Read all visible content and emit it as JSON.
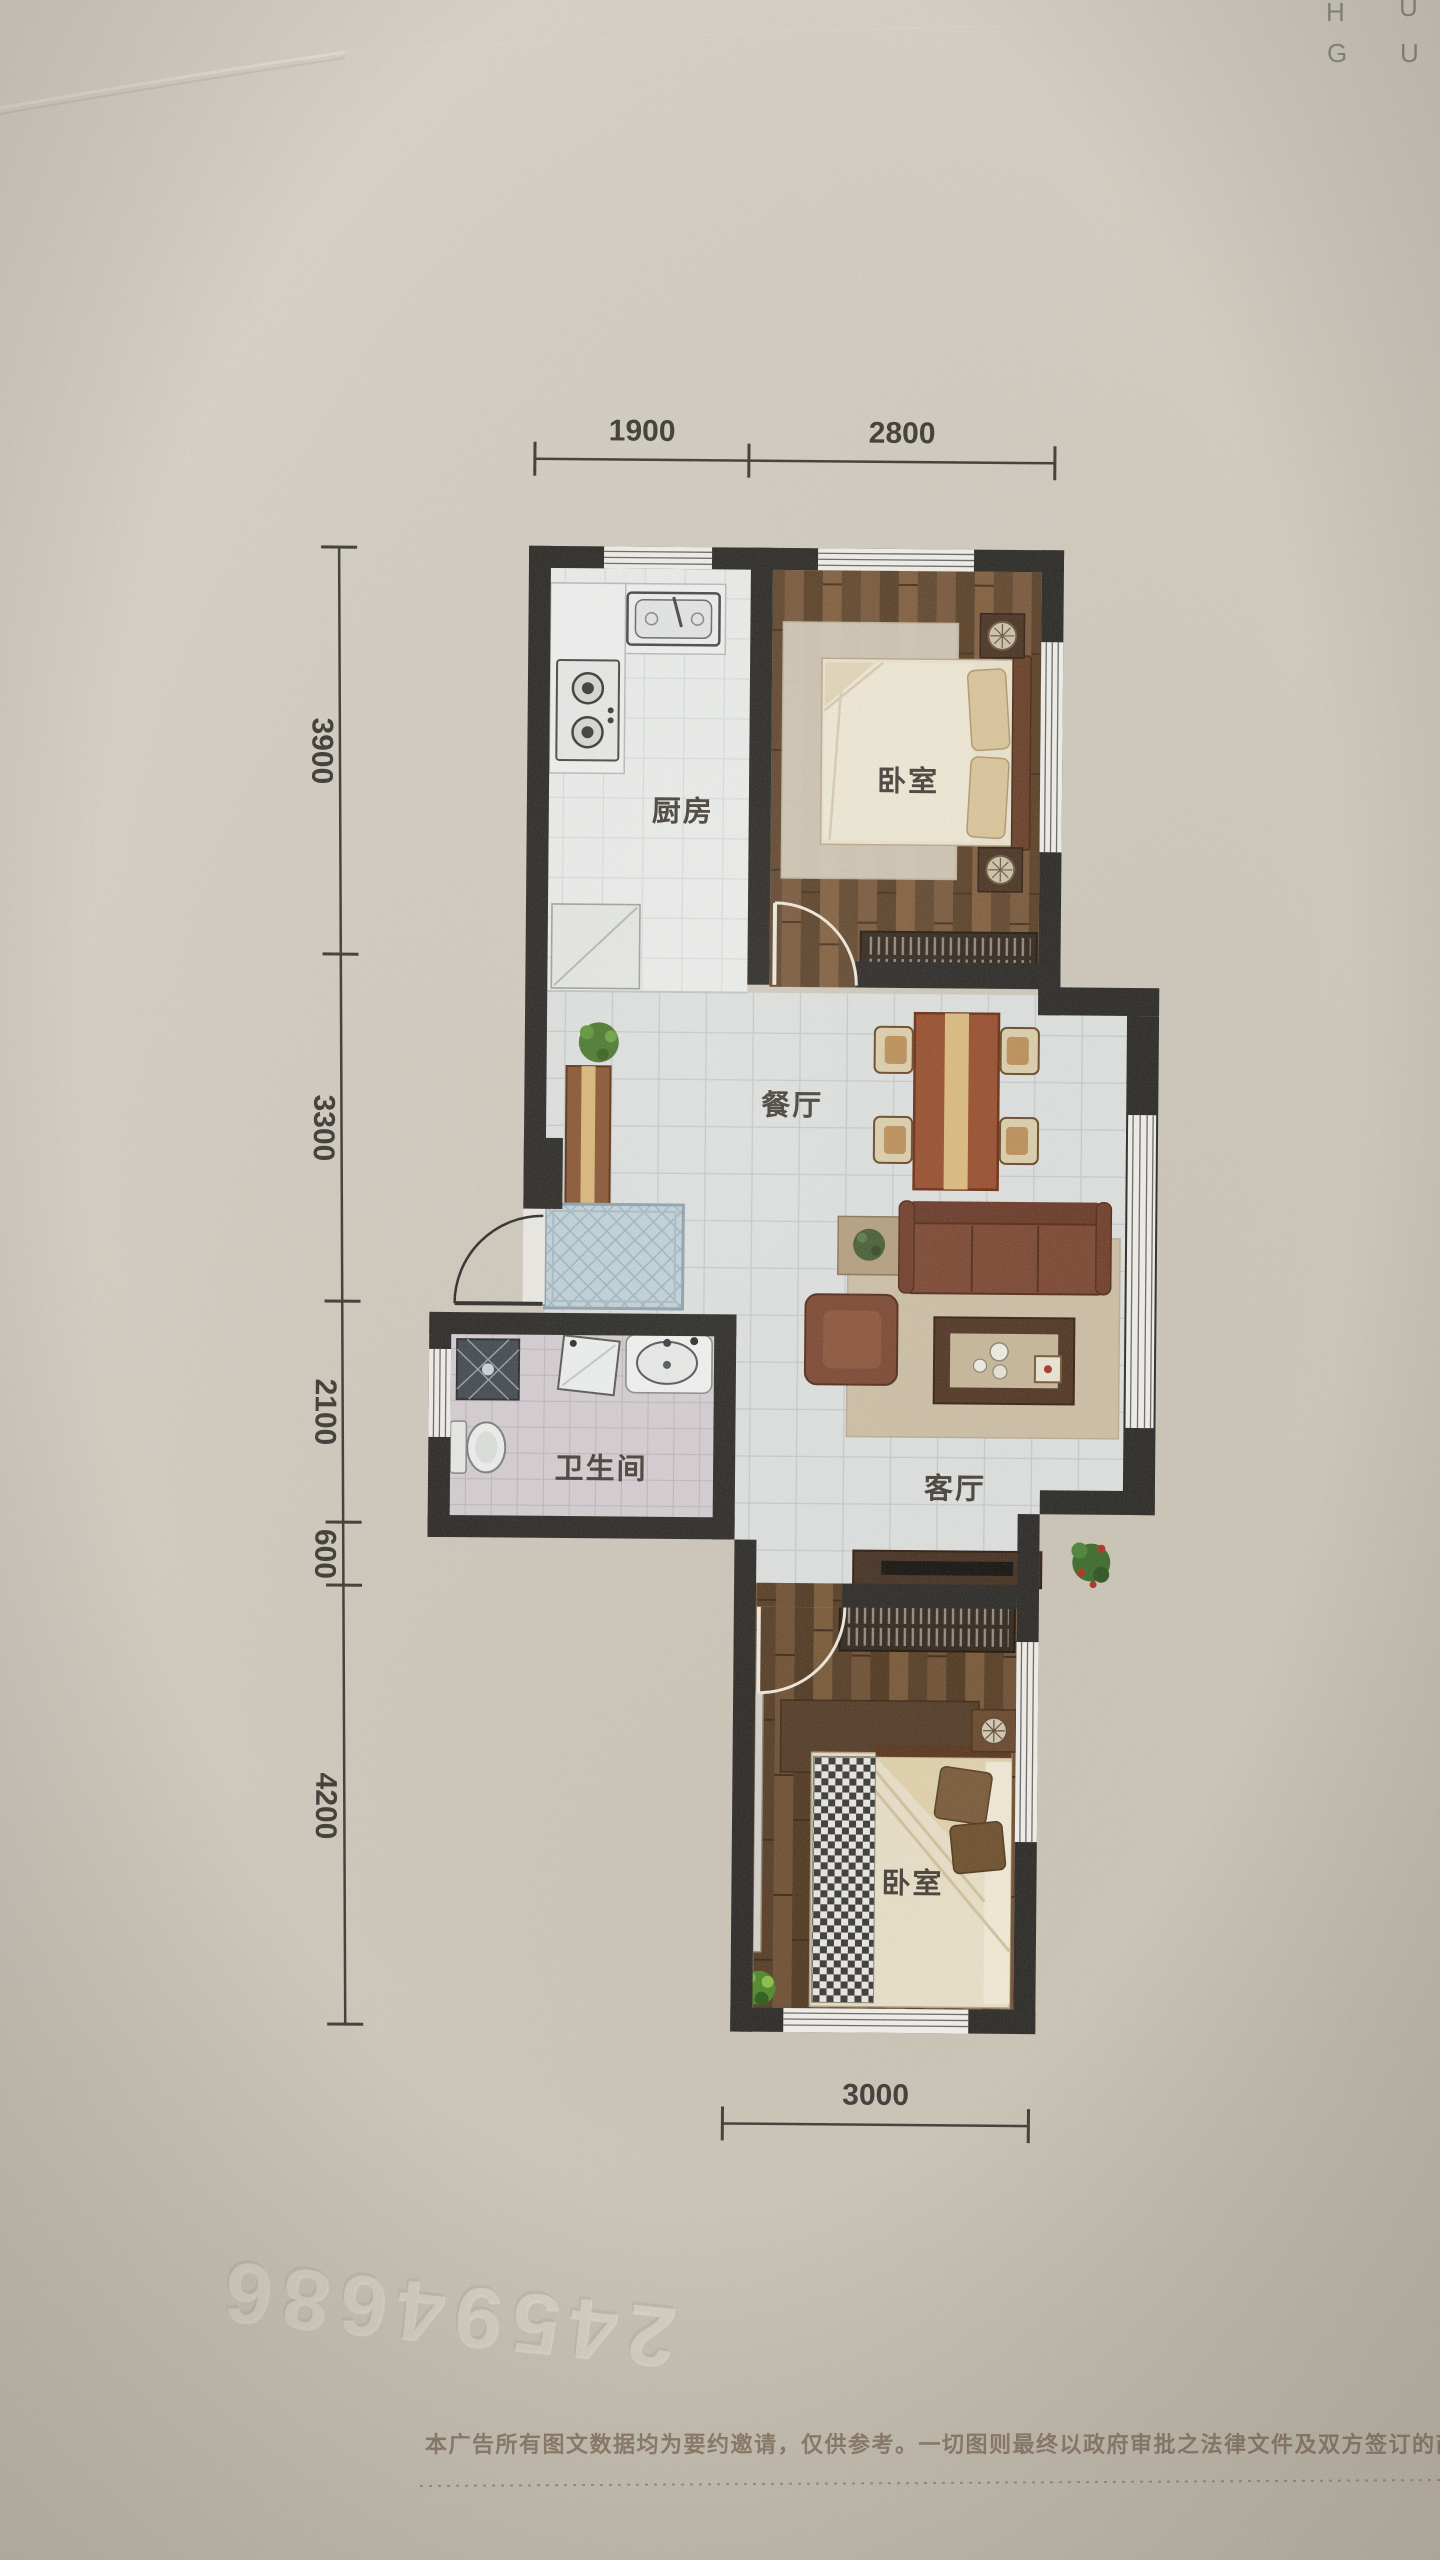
{
  "corner_mark": {
    "l1a": "H",
    "l1b": "U",
    "l2a": "G",
    "l2b": "U"
  },
  "dimensions": {
    "top": [
      "1900",
      "2800"
    ],
    "left": [
      "3900",
      "3300",
      "2100",
      "600",
      "4200"
    ],
    "bottom": [
      "3000"
    ]
  },
  "rooms": {
    "kitchen": "厨房",
    "bedroom_top": "卧室",
    "dining": "餐厅",
    "bathroom": "卫生间",
    "living": "客厅",
    "bedroom_bottom": "卧室"
  },
  "watermark": "24594686",
  "footer": {
    "disclaimer": "本广告所有图文数据均为要约邀请，仅供参考。一切图则最终以政府审批之法律文件及双方签订的商品房买卖合同"
  }
}
